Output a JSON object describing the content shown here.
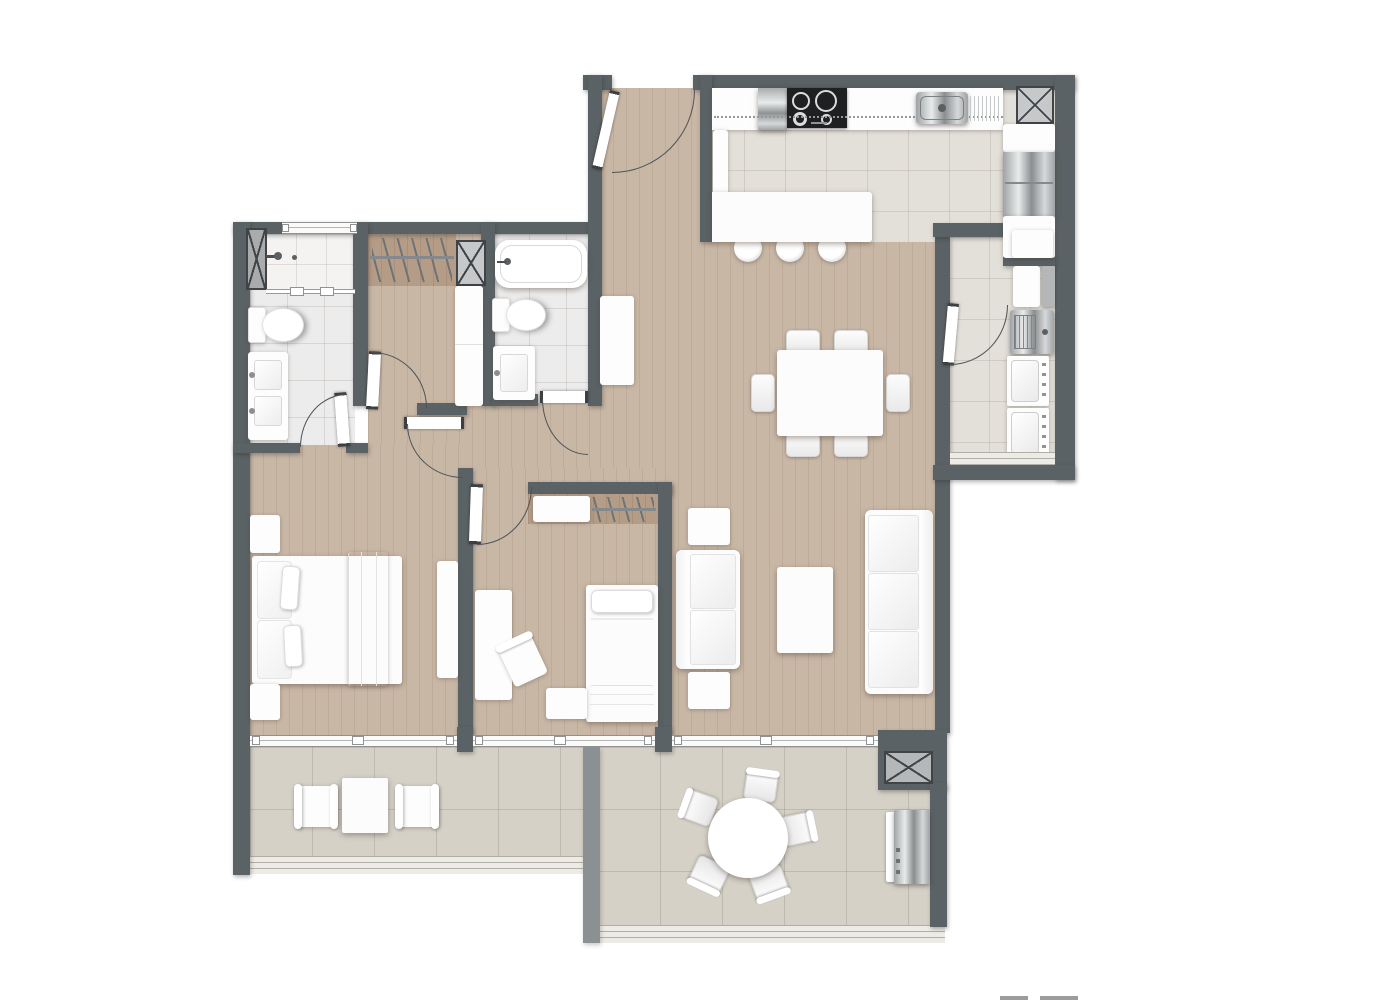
{
  "title": "apartment-floor-plan",
  "colors": {
    "wall": "#5a6265",
    "wall_light": "#8b9193",
    "wood": "#c9b7a6",
    "wood_dark": "#b59c87",
    "ktile": "#e3dfd9",
    "btile": "#edecec",
    "otile": "#d5d1c7",
    "grout": "rgba(120,110,100,0.18)",
    "groutT": "rgba(110,105,95,0.22)",
    "arc": "#4d5356",
    "paper": "#ffffff",
    "furniture": "#fcfcfc",
    "cooktop": "#1e2022"
  },
  "rooms": [
    {
      "name": "entry-hall",
      "items": [
        "entry-door"
      ]
    },
    {
      "name": "kitchen",
      "items": [
        "counter",
        "oven-column",
        "cooktop-4-burner",
        "sink-with-drainboard",
        "refrigerator",
        "island-counter",
        "bar-stool",
        "bar-stool",
        "bar-stool",
        "service-shaft"
      ]
    },
    {
      "name": "laundry",
      "items": [
        "upper-cabinet",
        "cabinet-white",
        "cabinet-gray",
        "laundry-sink",
        "washer",
        "dryer",
        "door",
        "window"
      ]
    },
    {
      "name": "dining-area",
      "items": [
        "dining-table",
        "chair",
        "chair",
        "chair",
        "chair",
        "chair",
        "chair",
        "console"
      ]
    },
    {
      "name": "living-room",
      "items": [
        "sofa-2-seat",
        "sofa-3-seat",
        "coffee-table",
        "side-table",
        "side-table",
        "sliding-window"
      ]
    },
    {
      "name": "master-bathroom",
      "items": [
        "shower",
        "shower-glass",
        "toilet",
        "double-vanity",
        "service-shaft",
        "window"
      ]
    },
    {
      "name": "walk-in-closet",
      "items": [
        "hanging-rail",
        "tall-cabinet",
        "service-shaft",
        "door"
      ]
    },
    {
      "name": "bathroom-2",
      "items": [
        "bathtub",
        "toilet",
        "vanity",
        "door"
      ]
    },
    {
      "name": "master-bedroom",
      "items": [
        "double-bed",
        "pillow",
        "pillow",
        "nightstand",
        "nightstand",
        "dresser",
        "sliding-window",
        "door"
      ]
    },
    {
      "name": "bedroom-2",
      "items": [
        "single-bed",
        "desk",
        "desk-chair",
        "nightstand",
        "closet-shelf",
        "closet-rail",
        "sliding-window",
        "door"
      ]
    },
    {
      "name": "balcony",
      "items": [
        "armchair",
        "armchair",
        "side-table",
        "railing-sill"
      ]
    },
    {
      "name": "terrace",
      "items": [
        "round-table",
        "chair",
        "chair",
        "chair",
        "chair",
        "chair",
        "grill",
        "service-shaft",
        "railing-sill"
      ]
    }
  ],
  "footer_marks": {
    "count": 2
  }
}
